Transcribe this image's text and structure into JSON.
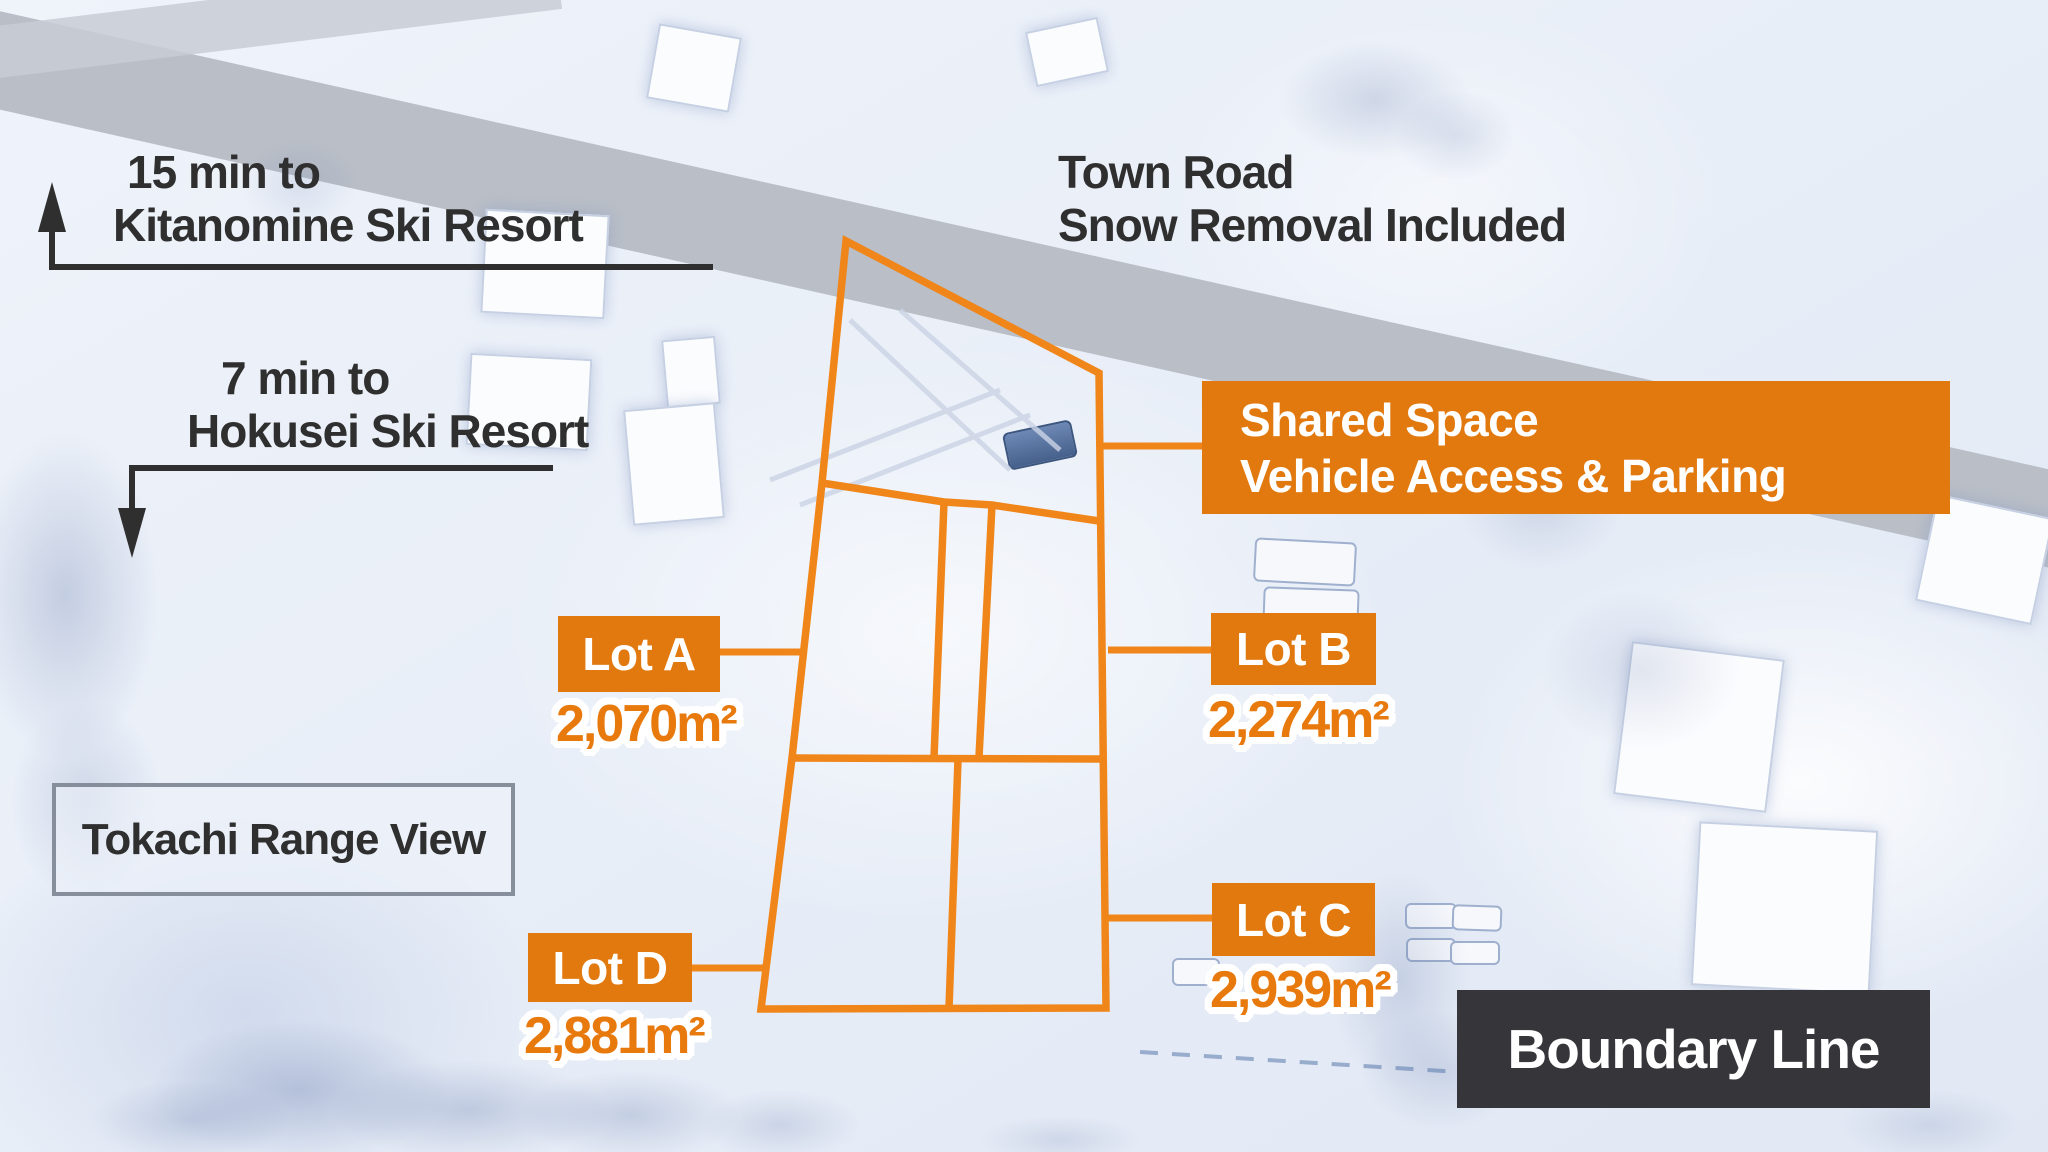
{
  "colors": {
    "accent_orange": "#E2790E",
    "boundary_line_orange": "#F0861A",
    "dark_text": "#2F2F2F",
    "legend_box_bg": "#35353A",
    "road_gray": "#B9BEC7"
  },
  "directions": {
    "kitanomine": {
      "line1": "15 min to",
      "line2": "Kitanomine Ski Resort",
      "arrow": "up"
    },
    "hokusei": {
      "line1": "7 min to",
      "line2": "Hokusei Ski Resort",
      "arrow": "down"
    }
  },
  "road_note": {
    "line1": "Town Road",
    "line2": "Snow Removal Included"
  },
  "shared_space": {
    "line1": "Shared Space",
    "line2": "Vehicle Access & Parking"
  },
  "view_note": {
    "label": "Tokachi Range View"
  },
  "legend": {
    "label": "Boundary Line"
  },
  "lots": [
    {
      "label": "Lot A",
      "area": "2,070m²"
    },
    {
      "label": "Lot B",
      "area": "2,274m²"
    },
    {
      "label": "Lot C",
      "area": "2,939m²"
    },
    {
      "label": "Lot D",
      "area": "2,881m²"
    }
  ]
}
